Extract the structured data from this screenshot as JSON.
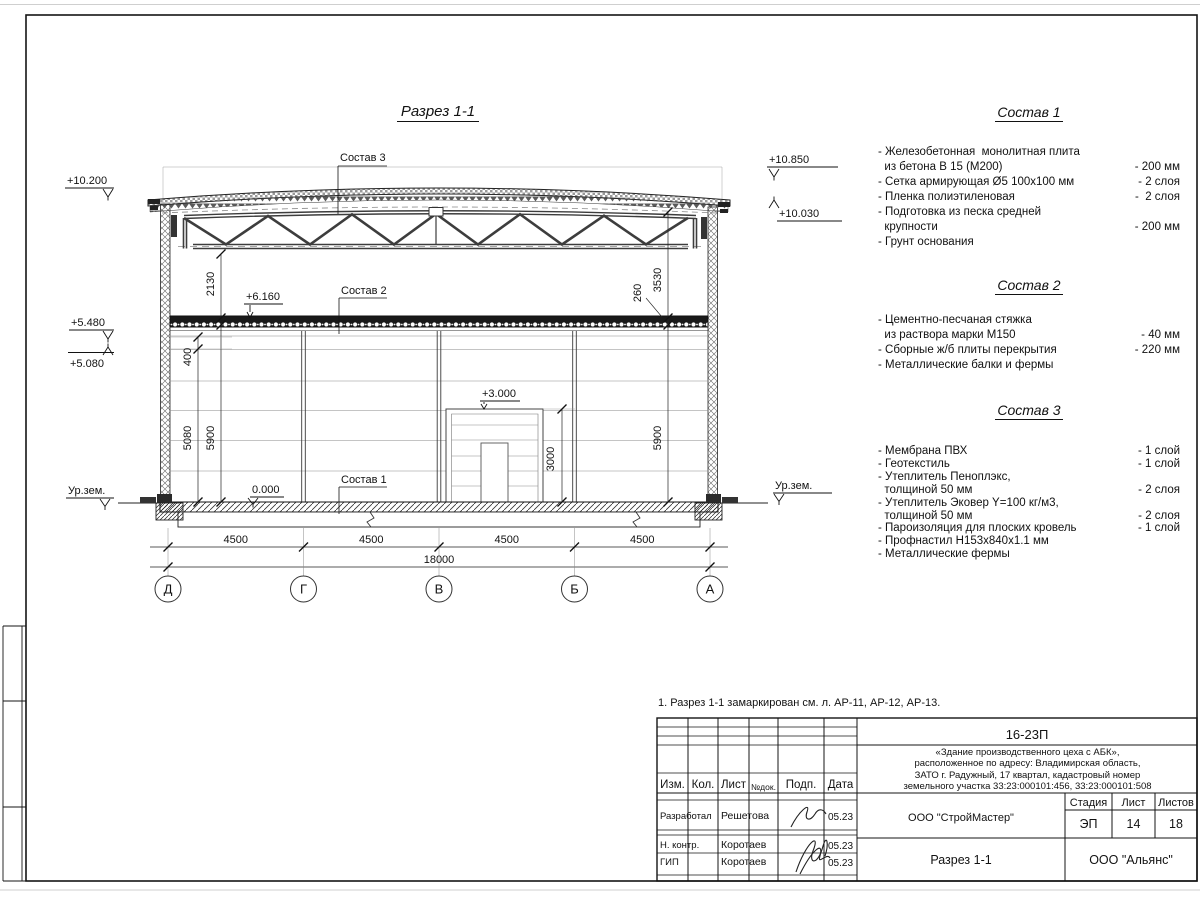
{
  "sheet": {
    "title": "Разрез 1-1",
    "note": "1. Разрез 1-1 замаркирован см. л. АР-11, АР-12, АР-13."
  },
  "marks": {
    "m10200": "+10.200",
    "m5480": "+5.480",
    "m5080": "+5.080",
    "m6160": "+6.160",
    "m3000": "+3.000",
    "m0000": "0.000",
    "m10850": "+10.850",
    "m10030": "+10.030",
    "ground_left": "Ур.зем.",
    "ground_right": "Ур.зем."
  },
  "leaders": {
    "s1": "Состав 1",
    "s2": "Состав 2",
    "s3": "Состав 3"
  },
  "dims": {
    "v2130": "2130",
    "v3530": "3530",
    "v260": "260",
    "v400": "400",
    "v5080": "5080",
    "v5900l": "5900",
    "v5900r": "5900",
    "v3000": "3000",
    "span1": "4500",
    "span2": "4500",
    "span3": "4500",
    "span4": "4500",
    "total": "18000"
  },
  "axes": {
    "a1": "Д",
    "a2": "Г",
    "a3": "В",
    "a4": "Б",
    "a5": "А"
  },
  "compositions": [
    {
      "title": "Состав 1",
      "items": [
        {
          "text": "- Железобетонная  монолитная плита",
          "value": ""
        },
        {
          "text": "  из бетона В 15 (М200)",
          "value": "- 200 мм"
        },
        {
          "text": "- Сетка армирующая Ø5 100х100 мм",
          "value": "- 2 слоя"
        },
        {
          "text": "- Пленка полиэтиленовая",
          "value": "-  2 слоя"
        },
        {
          "text": "- Подготовка из песка средней",
          "value": ""
        },
        {
          "text": "  крупности",
          "value": "- 200 мм"
        },
        {
          "text": "- Грунт основания",
          "value": ""
        }
      ]
    },
    {
      "title": "Состав 2",
      "items": [
        {
          "text": "- Цементно-песчаная стяжка",
          "value": ""
        },
        {
          "text": "  из раствора марки М150",
          "value": "- 40 мм"
        },
        {
          "text": "- Сборные ж/б плиты перекрытия",
          "value": "- 220 мм"
        },
        {
          "text": "- Металлические балки и фермы",
          "value": ""
        }
      ]
    },
    {
      "title": "Состав 3",
      "items": [
        {
          "text": "- Мембрана ПВХ",
          "value": "- 1 слой"
        },
        {
          "text": "- Геотекстиль",
          "value": "- 1 слой"
        },
        {
          "text": "- Утеплитель Пеноплэкс,",
          "value": ""
        },
        {
          "text": "  толщиной 50 мм",
          "value": "- 2 слоя"
        },
        {
          "text": "- Утеплитель Эковер Y=100 кг/м3,",
          "value": ""
        },
        {
          "text": "  толщиной 50 мм",
          "value": "- 2 слоя"
        },
        {
          "text": "- Пароизоляция для плоских кровель",
          "value": "- 1 слой"
        },
        {
          "text": "- Профнастил Н153х840х1.1 мм",
          "value": ""
        },
        {
          "text": "- Металлические фермы",
          "value": ""
        }
      ]
    }
  ],
  "titleblock": {
    "code": "16-23П",
    "object": "«Здание производственного цеха с АБК»,\nрасположенное по адресу: Владимирская область,\nЗАТО г. Радужный, 17 квартал, кадастровый номер\nземельного участка 33:23:000101:456, 33:23:000101:508",
    "cols": [
      "Изм.",
      "Кол.",
      "Лист",
      "№док.",
      "Подп.",
      "Дата"
    ],
    "rows": [
      {
        "role": "Разработал",
        "name": "Решетова",
        "date": "05.23"
      },
      {
        "role": "Н. контр.",
        "name": "Коротаев",
        "date": "05.23"
      },
      {
        "role": "ГИП",
        "name": "Коротаев",
        "date": "05.23"
      }
    ],
    "org": "ООО \"СтройМастер\"",
    "stage_label": "Стадия",
    "sheet_label": "Лист",
    "sheets_label": "Листов",
    "stage": "ЭП",
    "sheet_no": "14",
    "sheets_total": "18",
    "section_name": "Разрез 1-1",
    "org2": "ООО \"Альянс\""
  }
}
